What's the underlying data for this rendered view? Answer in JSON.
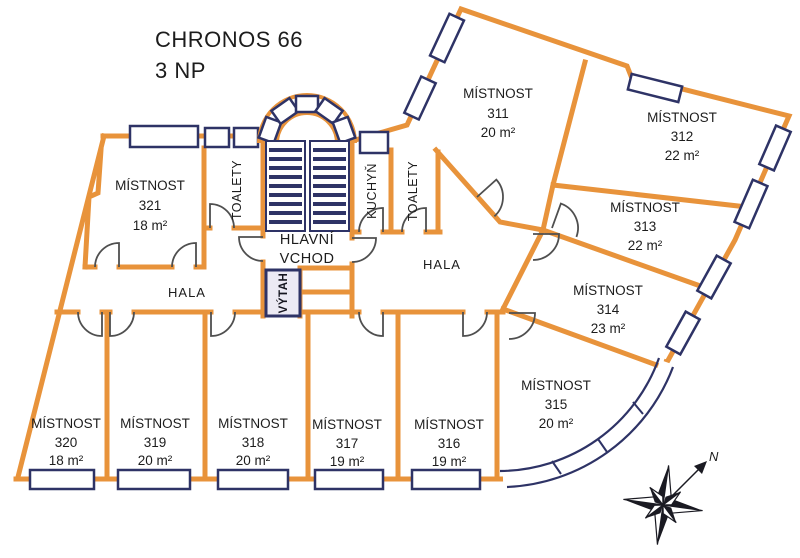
{
  "title": {
    "building": "CHRONOS 66",
    "floor": "3 NP"
  },
  "rooms": [
    {
      "label": "MÍSTNOST",
      "number": "321",
      "area": "18 m²"
    },
    {
      "label": "MÍSTNOST",
      "number": "311",
      "area": "20 m²"
    },
    {
      "label": "MÍSTNOST",
      "number": "312",
      "area": "22 m²"
    },
    {
      "label": "MÍSTNOST",
      "number": "313",
      "area": "22 m²"
    },
    {
      "label": "MÍSTNOST",
      "number": "314",
      "area": "23 m²"
    },
    {
      "label": "MÍSTNOST",
      "number": "315",
      "area": "20 m²"
    },
    {
      "label": "MÍSTNOST",
      "number": "316",
      "area": "19 m²"
    },
    {
      "label": "MÍSTNOST",
      "number": "317",
      "area": "19 m²"
    },
    {
      "label": "MÍSTNOST",
      "number": "318",
      "area": "20 m²"
    },
    {
      "label": "MÍSTNOST",
      "number": "319",
      "area": "20 m²"
    },
    {
      "label": "MÍSTNOST",
      "number": "320",
      "area": "18 m²"
    }
  ],
  "areas": {
    "hala_left": "HALA",
    "hala_right": "HALA",
    "toalety_left": "TOALETY",
    "toalety_right": "TOALETY",
    "kuchyn": "KUCHYŇ",
    "vytah": "VÝTAH",
    "hlavni_vchod_line1": "HLAVNÍ",
    "hlavni_vchod_line2": "VCHOD"
  },
  "compass": {
    "north_label": "N"
  },
  "colors": {
    "wall": "#e8933b",
    "window_frame": "#2e3366",
    "door": "#4f4f4f",
    "text": "#1c1c1c",
    "elevator_fill": "#eceaf4",
    "background": "#ffffff"
  }
}
